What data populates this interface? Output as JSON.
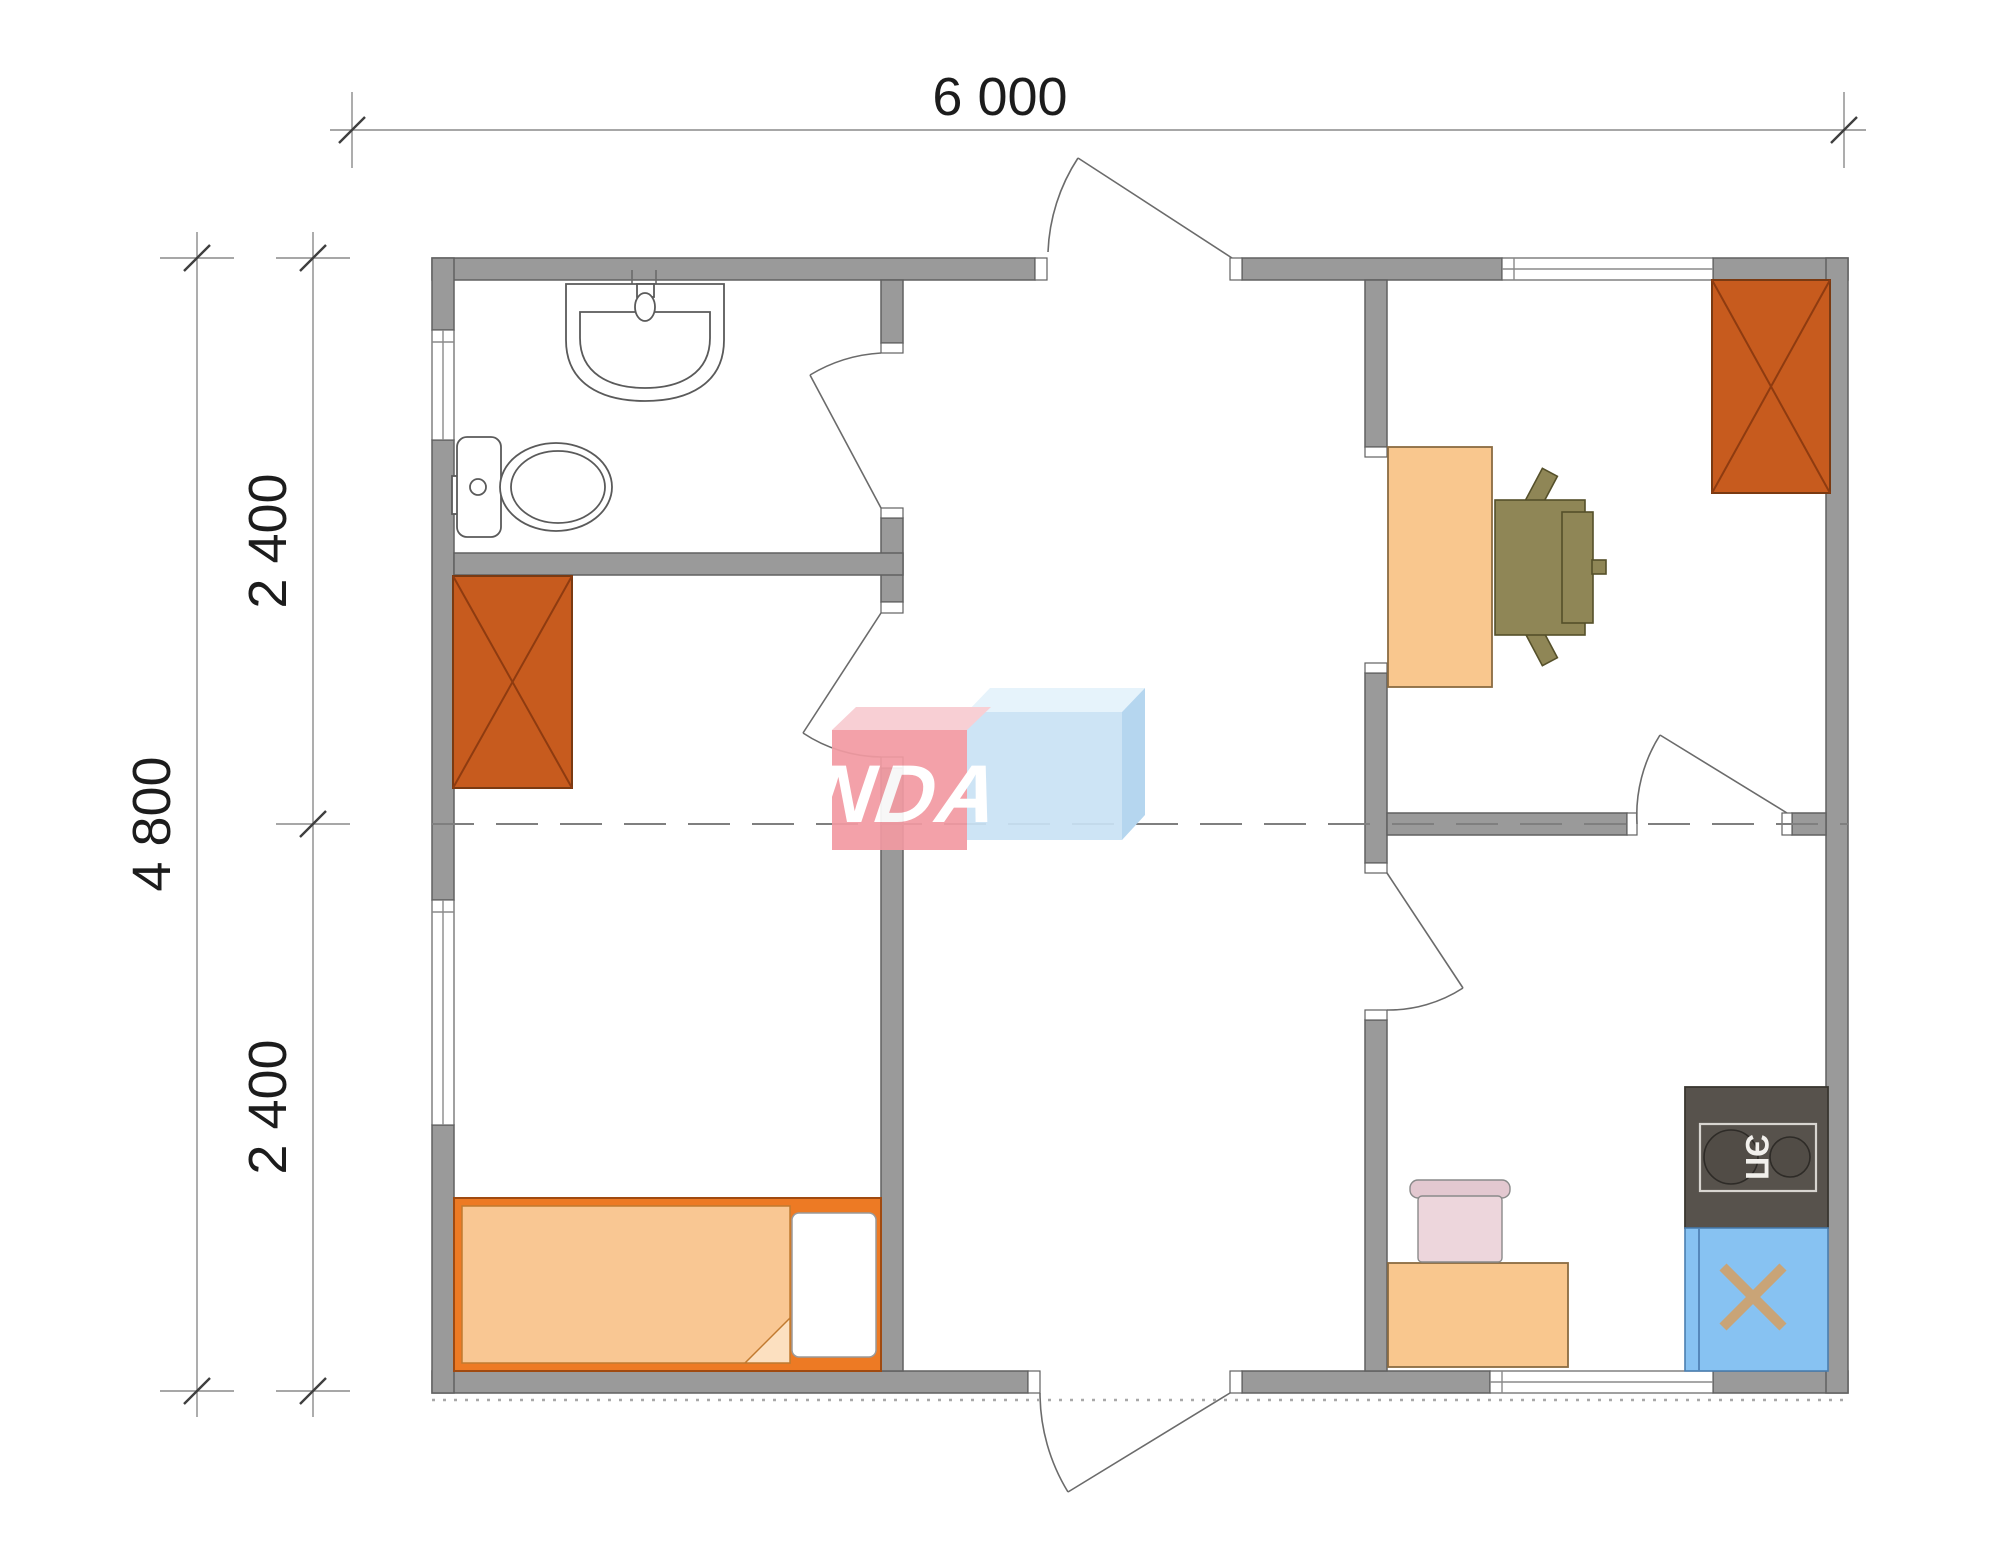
{
  "drawing": {
    "type": "floor-plan",
    "dimension_labels": {
      "top_width": "6 000",
      "left_total_height": "4 800",
      "left_upper_height": "2 400",
      "left_lower_height": "2 400"
    },
    "watermark": {
      "text": "VANDA",
      "red_box_color": "#F29AA2",
      "blue_box_color": "#C9E2F5"
    },
    "appliance_labels": {
      "stove": "ЭП"
    },
    "colors": {
      "wall_fill": "#9A9A9A",
      "wall_outline": "#616161",
      "wardrobe": "#C75B1E",
      "wardrobe_cross": "#8E3B10",
      "bed_frame": "#ED7A24",
      "bed_blanket": "#F9C793",
      "pillow": "#FFFFFF",
      "desk": "#F9C78E",
      "office_chair": "#8F8656",
      "stove": "#57524C",
      "kitchen_sink_cabinet": "#87C2F2",
      "sink_x_mark": "#C9A477",
      "kitchen_chair": "#EDD6DC"
    },
    "fixtures": [
      "bathroom-sink",
      "toilet",
      "wardrobe-left",
      "wardrobe-right",
      "bed",
      "desk",
      "office-chair",
      "stove",
      "kitchen-sink-cabinet",
      "kitchen-cabinet",
      "kitchen-chair"
    ]
  }
}
